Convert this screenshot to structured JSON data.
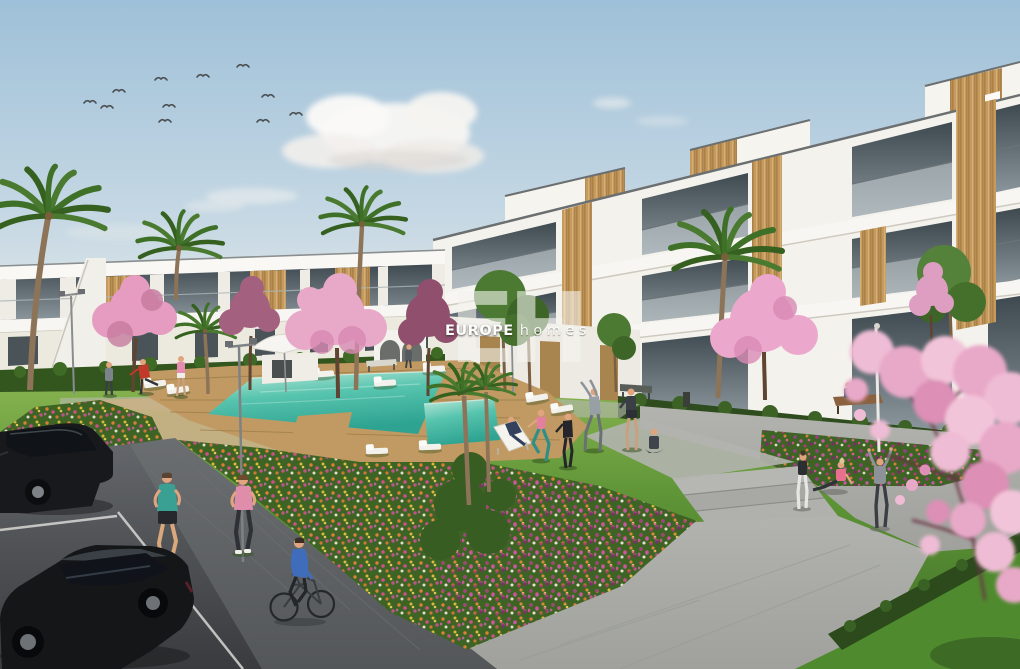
{
  "meta": {
    "type": "architectural-3d-render",
    "description": "New-build residential complex render: white modern apartment blocks with wood accents, communal lawn with swimming pool, flower beds, cherry-blossom and palm trees, people exercising, joggers, a cyclist and a small parking area with two black cars.",
    "canvas": {
      "width": 1020,
      "height": 669
    }
  },
  "watermark": {
    "monogram": {
      "letter_1": "E",
      "letter_2": "H"
    },
    "brand": "EUROPE",
    "brand_suffix": "homes"
  },
  "palette": {
    "sky_top": "#9ec0d8",
    "sky_horizon": "#e9ece9",
    "cloud_white": "#f7f6f3",
    "building_white": "#f4f2ed",
    "building_shadow": "#d9d4ca",
    "wood_accent": "#c49a5e",
    "window_glass": "#46525a",
    "grass_light": "#84b14e",
    "grass_dark": "#3f6e26",
    "pool_water": "#54c3ae",
    "pool_deep": "#2ea391",
    "deck_wood": "#c09a62",
    "blossom_pink": "#e8a8c8",
    "blossom_mauve": "#a4607f",
    "flower_orange": "#e8823a",
    "flower_magenta": "#c9518e",
    "flower_purple": "#9b3d86",
    "flower_yellow": "#e8c13a",
    "walkway_gray": "#a6a7a2",
    "bike_path_gray": "#5d6063",
    "asphalt": "#4a4d50",
    "car_black": "#17191c",
    "lamp_gray": "#8a8d8e",
    "skin": "#e0a57f",
    "watermark_white": "#f4f3ee"
  },
  "scene": {
    "sky": {
      "birds": 11,
      "clouds": 6
    },
    "buildings": {
      "left": "two-storey white terraced apartments with wood panels",
      "right": "three-storey stepped white apartment block with glass balconies and wood panels"
    },
    "pool": {
      "shape": "rectangular with spa section and timber deck",
      "sun_loungers": 11,
      "umbrellas": 1
    },
    "people": {
      "total": 18,
      "activities": [
        "jogging",
        "cycling",
        "stretching",
        "yoga",
        "sunbathing",
        "sitting on bench",
        "walking"
      ]
    },
    "vehicles": {
      "parked_cars": 2,
      "bicycles": 1
    },
    "vegetation": [
      "palm trees",
      "cherry blossom trees",
      "flower beds",
      "hedges",
      "lawn"
    ],
    "street_lamps": 4,
    "benches": 3
  }
}
